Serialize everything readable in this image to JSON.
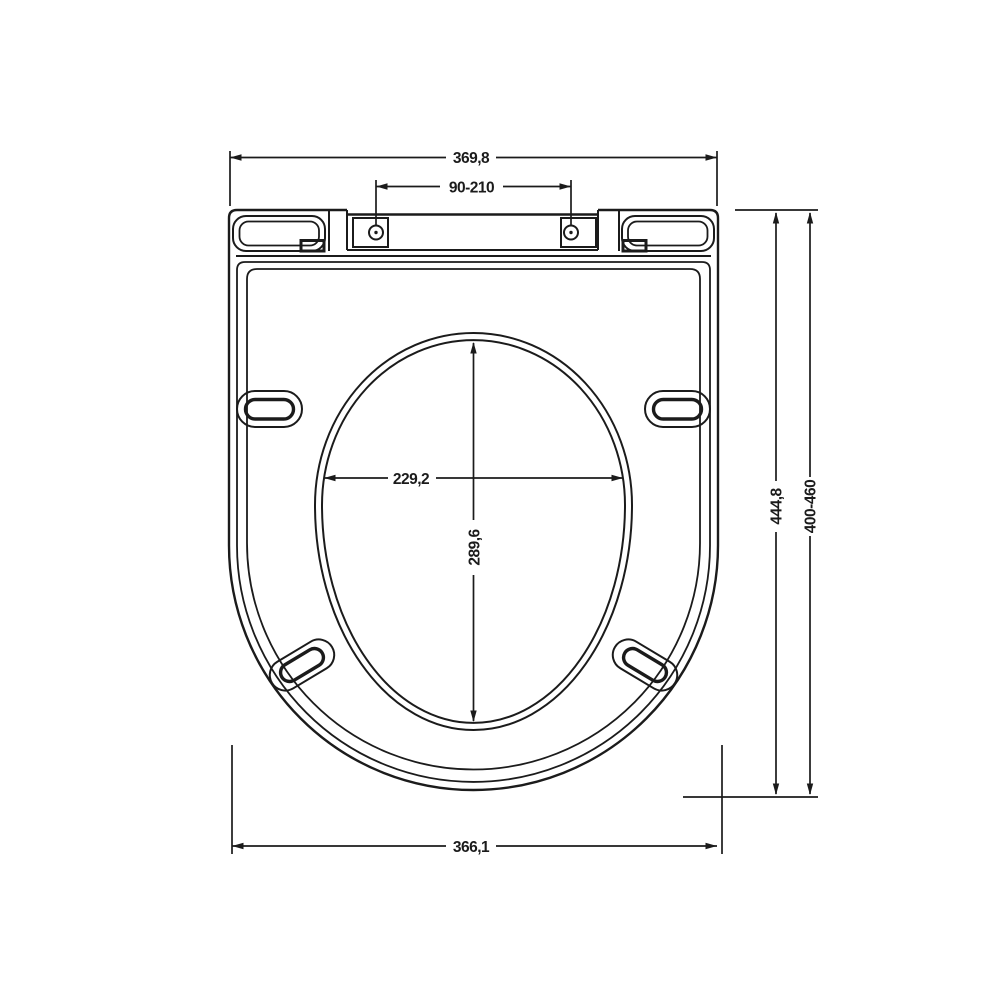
{
  "drawing": {
    "type": "technical-dimension-drawing",
    "subject": "toilet-seat-top-view",
    "background_color": "#ffffff",
    "line_color": "#1b1b1b",
    "dimensions": {
      "top_width": "369,8",
      "hinge_hole_spacing": "90-210",
      "overall_length": "444,8",
      "mounting_length_range": "400-460",
      "opening_width": "229,2",
      "opening_length": "289,6",
      "bottom_width": "366,1"
    }
  }
}
